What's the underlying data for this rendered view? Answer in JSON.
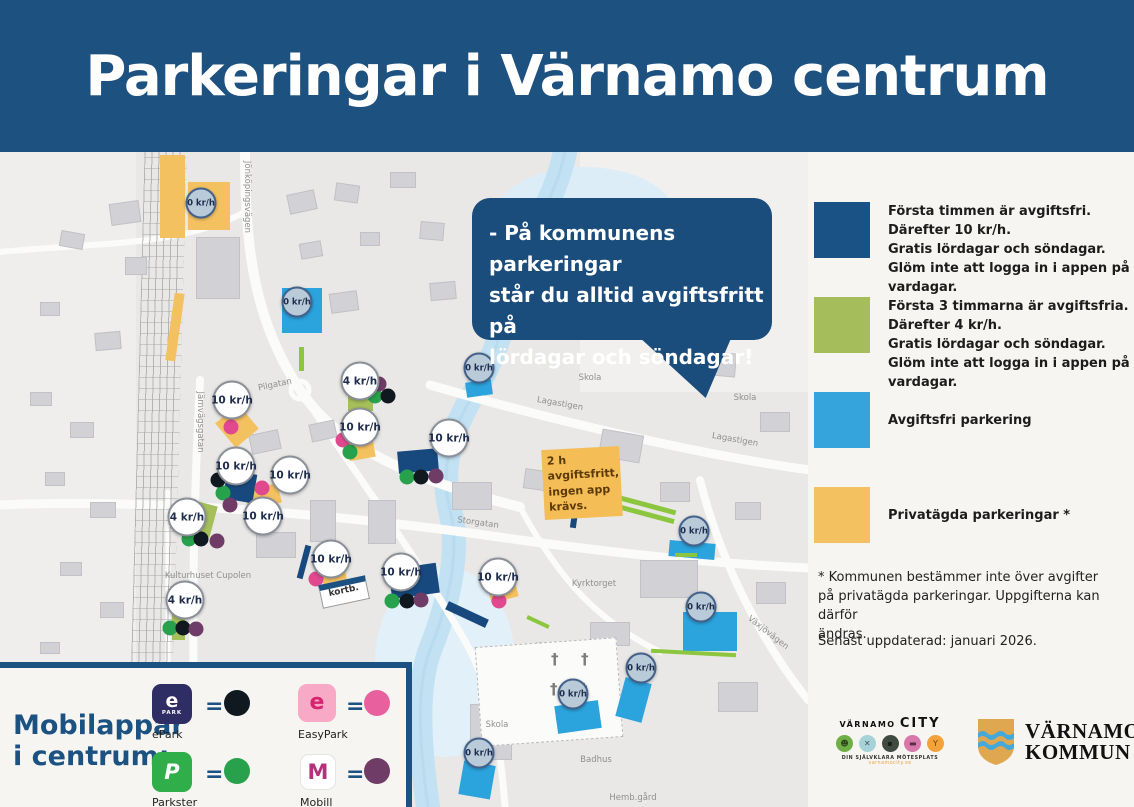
{
  "title": "Parkeringar i Värnamo centrum",
  "speech_bubble": {
    "lines": [
      "- På kommunens parkeringar",
      "står du alltid avgiftsfritt på",
      "lördagar och söndagar!"
    ]
  },
  "legend": {
    "items": [
      {
        "name": "kommunal-10kr",
        "color": "#1b5285",
        "lines": [
          "Första timmen är avgiftsfri.",
          "Därefter 10 kr/h.",
          "Gratis lördagar och söndagar.",
          "Glöm inte att logga in i appen på vardagar."
        ]
      },
      {
        "name": "kommunal-4kr",
        "color": "#a6bd5c",
        "lines": [
          "Första 3 timmarna är avgiftsfria.",
          "Därefter 4 kr/h.",
          "Gratis lördagar och söndagar.",
          "Glöm inte att logga in i appen på vardagar."
        ]
      },
      {
        "name": "avgiftsfri",
        "color": "#36a4dc",
        "lines": [
          "Avgiftsfri parkering"
        ]
      },
      {
        "name": "privatagd",
        "color": "#f4c160",
        "lines": [
          "Privatägda parkeringar *"
        ]
      }
    ],
    "footnote_lines": [
      "* Kommunen bestämmer inte över avgifter",
      "på privatägda parkeringar. Uppgifterna kan därför",
      "ändras."
    ],
    "updated": "Senast uppdaterad: januari 2026."
  },
  "apps_panel": {
    "title_lines": [
      "Mobilappar",
      "i centrum:"
    ],
    "equals_sign": "=",
    "apps": [
      {
        "name": "ePark",
        "icon_bg": "#2e2d64",
        "icon_text": "e",
        "icon_sub": "PARK",
        "dot_color": "#101820"
      },
      {
        "name": "EasyPark",
        "icon_bg": "#f7a9c6",
        "icon_text": "e",
        "icon_sub": "",
        "dot_color": "#e8619e"
      },
      {
        "name": "Parkster",
        "icon_bg": "#2fae4a",
        "icon_text": "P",
        "icon_sub": "",
        "dot_color": "#27a14b"
      },
      {
        "name": "Mobill",
        "icon_bg": "#ffffff",
        "icon_text": "M",
        "icon_sub": "",
        "dot_color": "#6f3c67"
      }
    ]
  },
  "map": {
    "note_lines": [
      "2 h avgiftsfritt,",
      "ingen app krävs."
    ],
    "kortb_label": "kortb.",
    "dot_colors": {
      "black": "#101820",
      "pink": "#e0498e",
      "green": "#27a14b",
      "purple": "#6f3c67"
    },
    "markers": [
      {
        "t": "free",
        "l": "0 kr/h",
        "x": 201,
        "y": 51
      },
      {
        "t": "free",
        "l": "0 kr/h",
        "x": 297,
        "y": 150
      },
      {
        "t": "free",
        "l": "0 kr/h",
        "x": 479,
        "y": 216
      },
      {
        "t": "free",
        "l": "0 kr/h",
        "x": 694,
        "y": 379
      },
      {
        "t": "free",
        "l": "0 kr/h",
        "x": 701,
        "y": 455
      },
      {
        "t": "free",
        "l": "0 kr/h",
        "x": 641,
        "y": 516
      },
      {
        "t": "free",
        "l": "0 kr/h",
        "x": 573,
        "y": 542
      },
      {
        "t": "free",
        "l": "0 kr/h",
        "x": 479,
        "y": 601
      },
      {
        "t": "paid",
        "l": "10 kr/h",
        "x": 232,
        "y": 248
      },
      {
        "t": "paid",
        "l": "10 kr/h",
        "x": 236,
        "y": 314
      },
      {
        "t": "paid",
        "l": "10 kr/h",
        "x": 290,
        "y": 323
      },
      {
        "t": "paid",
        "l": "10 kr/h",
        "x": 263,
        "y": 364
      },
      {
        "t": "paid",
        "l": "10 kr/h",
        "x": 360,
        "y": 275
      },
      {
        "t": "paid",
        "l": "10 kr/h",
        "x": 449,
        "y": 286
      },
      {
        "t": "paid",
        "l": "10 kr/h",
        "x": 331,
        "y": 407
      },
      {
        "t": "paid",
        "l": "10 kr/h",
        "x": 401,
        "y": 420
      },
      {
        "t": "paid",
        "l": "10 kr/h",
        "x": 498,
        "y": 425
      },
      {
        "t": "paid",
        "l": "4 kr/h",
        "x": 360,
        "y": 229
      },
      {
        "t": "paid",
        "l": "4 kr/h",
        "x": 187,
        "y": 365
      },
      {
        "t": "paid",
        "l": "4 kr/h",
        "x": 185,
        "y": 448
      }
    ],
    "dots": [
      {
        "c": "pink",
        "x": 231,
        "y": 275
      },
      {
        "c": "pink",
        "x": 262,
        "y": 336
      },
      {
        "c": "pink",
        "x": 343,
        "y": 288
      },
      {
        "c": "pink",
        "x": 316,
        "y": 427
      },
      {
        "c": "pink",
        "x": 499,
        "y": 449
      },
      {
        "c": "green",
        "x": 375,
        "y": 244
      },
      {
        "c": "green",
        "x": 350,
        "y": 300
      },
      {
        "c": "green",
        "x": 223,
        "y": 341
      },
      {
        "c": "green",
        "x": 189,
        "y": 387
      },
      {
        "c": "green",
        "x": 170,
        "y": 476
      },
      {
        "c": "green",
        "x": 407,
        "y": 325
      },
      {
        "c": "green",
        "x": 392,
        "y": 449
      },
      {
        "c": "black",
        "x": 388,
        "y": 244
      },
      {
        "c": "black",
        "x": 218,
        "y": 328
      },
      {
        "c": "black",
        "x": 201,
        "y": 387
      },
      {
        "c": "black",
        "x": 183,
        "y": 476
      },
      {
        "c": "black",
        "x": 421,
        "y": 325
      },
      {
        "c": "black",
        "x": 407,
        "y": 449
      },
      {
        "c": "purple",
        "x": 379,
        "y": 232
      },
      {
        "c": "purple",
        "x": 230,
        "y": 353
      },
      {
        "c": "purple",
        "x": 217,
        "y": 389
      },
      {
        "c": "purple",
        "x": 196,
        "y": 477
      },
      {
        "c": "purple",
        "x": 436,
        "y": 324
      },
      {
        "c": "purple",
        "x": 421,
        "y": 448
      }
    ],
    "areas": [
      {
        "k": "orange",
        "x": 160,
        "y": 3,
        "w": 25,
        "h": 83,
        "r": 0
      },
      {
        "k": "orange",
        "x": 188,
        "y": 30,
        "w": 42,
        "h": 48,
        "r": 0
      },
      {
        "k": "orange",
        "x": 170,
        "y": 141,
        "w": 10,
        "h": 68,
        "r": 8
      },
      {
        "k": "orange",
        "x": 222,
        "y": 258,
        "w": 30,
        "h": 32,
        "r": -40
      },
      {
        "k": "orange",
        "x": 246,
        "y": 335,
        "w": 34,
        "h": 20,
        "r": -15
      },
      {
        "k": "orange",
        "x": 348,
        "y": 285,
        "w": 26,
        "h": 22,
        "r": -10
      },
      {
        "k": "orange",
        "x": 322,
        "y": 414,
        "w": 24,
        "h": 20,
        "r": -10
      },
      {
        "k": "orange",
        "x": 489,
        "y": 431,
        "w": 28,
        "h": 17,
        "r": -15
      },
      {
        "k": "blue",
        "x": 282,
        "y": 136,
        "w": 40,
        "h": 45,
        "r": 0
      },
      {
        "k": "blue",
        "x": 466,
        "y": 229,
        "w": 26,
        "h": 15,
        "r": -8
      },
      {
        "k": "blue",
        "x": 669,
        "y": 390,
        "w": 46,
        "h": 16,
        "r": 5
      },
      {
        "k": "blue",
        "x": 683,
        "y": 460,
        "w": 54,
        "h": 39,
        "r": 0
      },
      {
        "k": "blue",
        "x": 620,
        "y": 528,
        "w": 27,
        "h": 40,
        "r": 15
      },
      {
        "k": "blue",
        "x": 556,
        "y": 551,
        "w": 44,
        "h": 28,
        "r": -8
      },
      {
        "k": "blue",
        "x": 461,
        "y": 611,
        "w": 32,
        "h": 34,
        "r": 10
      },
      {
        "k": "navy",
        "x": 225,
        "y": 320,
        "w": 30,
        "h": 29,
        "r": 10
      },
      {
        "k": "navy",
        "x": 398,
        "y": 298,
        "w": 40,
        "h": 22,
        "r": -5
      },
      {
        "k": "navy",
        "x": 390,
        "y": 414,
        "w": 48,
        "h": 30,
        "r": -8
      },
      {
        "k": "navy",
        "x": 445,
        "y": 458,
        "w": 44,
        "h": 9,
        "r": 25
      },
      {
        "k": "navy",
        "x": 572,
        "y": 345,
        "w": 6,
        "h": 31,
        "r": 8
      },
      {
        "k": "navy",
        "x": 301,
        "y": 393,
        "w": 6,
        "h": 34,
        "r": 15
      },
      {
        "k": "green",
        "x": 348,
        "y": 233,
        "w": 25,
        "h": 26,
        "r": 0
      },
      {
        "k": "green",
        "x": 190,
        "y": 351,
        "w": 24,
        "h": 32,
        "r": 15
      },
      {
        "k": "green",
        "x": 172,
        "y": 458,
        "w": 13,
        "h": 30,
        "r": 0
      },
      {
        "k": "greenline",
        "x": 597,
        "y": 348,
        "w": 80,
        "h": 5,
        "r": 15
      },
      {
        "k": "greenline",
        "x": 620,
        "y": 360,
        "w": 55,
        "h": 5,
        "r": 15
      },
      {
        "k": "greenline",
        "x": 651,
        "y": 499,
        "w": 85,
        "h": 4,
        "r": 3
      },
      {
        "k": "greenline",
        "x": 675,
        "y": 401,
        "w": 22,
        "h": 4,
        "r": 0
      },
      {
        "k": "greenline",
        "x": 526,
        "y": 468,
        "w": 24,
        "h": 4,
        "r": 25
      },
      {
        "k": "greenline",
        "x": 299,
        "y": 195,
        "w": 5,
        "h": 24,
        "r": 0
      }
    ],
    "street_labels": [
      {
        "t": "Jönköpingsvägen",
        "x": 247,
        "y": 45,
        "r": 90
      },
      {
        "t": "Järnvägsgatan",
        "x": 200,
        "y": 270,
        "r": 90
      },
      {
        "t": "Pilgatan",
        "x": 275,
        "y": 233,
        "r": -12
      },
      {
        "t": "Lagastigen",
        "x": 560,
        "y": 252,
        "r": 10
      },
      {
        "t": "Lagastigen",
        "x": 735,
        "y": 288,
        "r": 10
      },
      {
        "t": "Storgatan",
        "x": 478,
        "y": 371,
        "r": 8
      },
      {
        "t": "Växjövägen",
        "x": 768,
        "y": 481,
        "r": 38
      },
      {
        "t": "Kyrktorget",
        "x": 594,
        "y": 432,
        "r": 0
      },
      {
        "t": "Skola",
        "x": 590,
        "y": 226,
        "r": 0
      },
      {
        "t": "Skola",
        "x": 745,
        "y": 246,
        "r": 0
      },
      {
        "t": "Skola",
        "x": 497,
        "y": 573,
        "r": 0
      },
      {
        "t": "Badhus",
        "x": 596,
        "y": 608,
        "r": 0
      },
      {
        "t": "Hemb.gård",
        "x": 633,
        "y": 646,
        "r": 0
      },
      {
        "t": "Kulturhuset Cupolen",
        "x": 208,
        "y": 424,
        "r": 0
      }
    ]
  },
  "logos": {
    "city": {
      "name_small": "VÄRNAMO",
      "name_big": "CITY",
      "tagline": "DIN SJÄLVKLARA MÖTESPLATS",
      "url": "varnamocity.se",
      "icons": [
        {
          "name": "people-icon",
          "color": "#6faf47",
          "glyph": "☻"
        },
        {
          "name": "dining-icon",
          "color": "#a7d3d8",
          "glyph": "✕"
        },
        {
          "name": "camera-icon",
          "color": "#3f4b3f",
          "glyph": "▪"
        },
        {
          "name": "screen-icon",
          "color": "#d877aa",
          "glyph": "▬"
        },
        {
          "name": "drink-icon",
          "color": "#f3a23a",
          "glyph": "Y"
        }
      ]
    },
    "kommun": {
      "line1": "VÄRNAMO",
      "line2": "KOMMUN"
    }
  }
}
